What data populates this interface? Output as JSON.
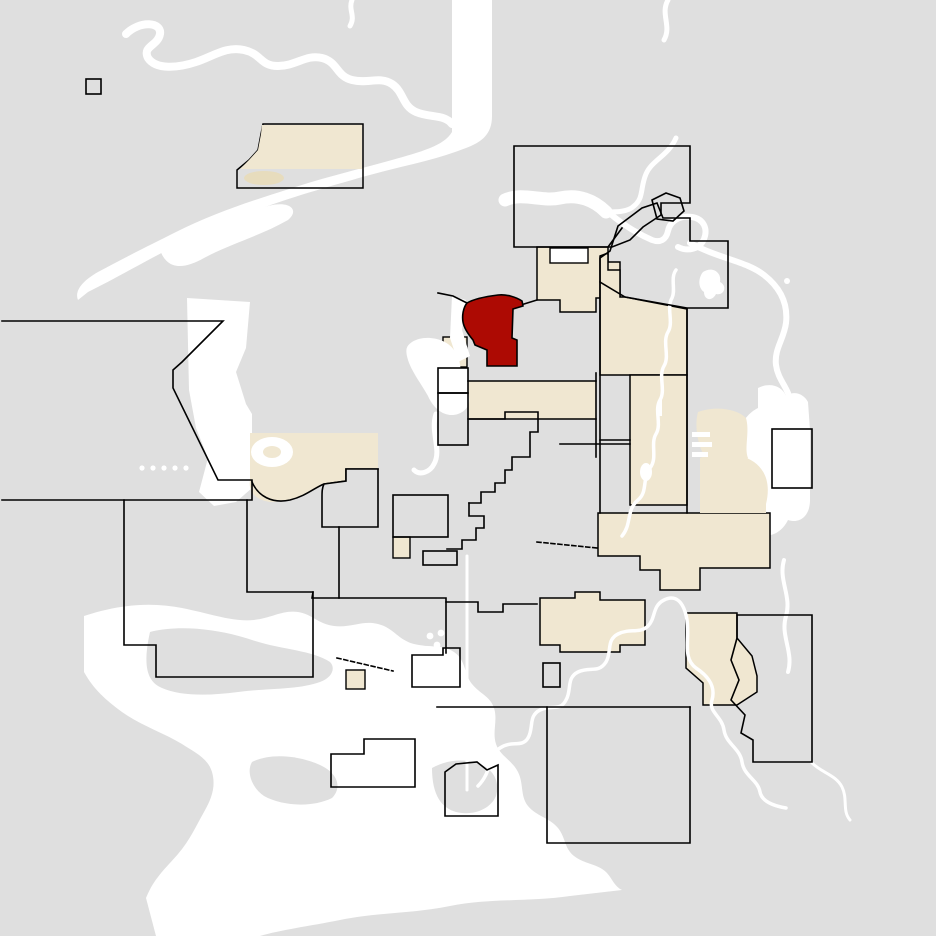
{
  "map": {
    "kind": "municipal-locator-map",
    "canvas": {
      "width": 936,
      "height": 936
    },
    "colors": {
      "background": "#dfdfdf",
      "water": "#ffffff",
      "urban": "#f0e7d1",
      "urban_shade": "#e7dcbd",
      "highlight": "#ad0a03",
      "boundary": "#000000"
    },
    "features": [
      {
        "id": "highlighted-municipality",
        "kind": "selected region",
        "color_ref": "highlight"
      },
      {
        "id": "urban-areas",
        "kind": "built-up areas",
        "color_ref": "urban"
      },
      {
        "id": "water-bodies",
        "kind": "rivers and lakes",
        "color_ref": "water"
      },
      {
        "id": "municipal-boundaries",
        "kind": "boundary lines",
        "color_ref": "boundary"
      },
      {
        "id": "rural-land",
        "kind": "county land",
        "color_ref": "background"
      }
    ]
  }
}
